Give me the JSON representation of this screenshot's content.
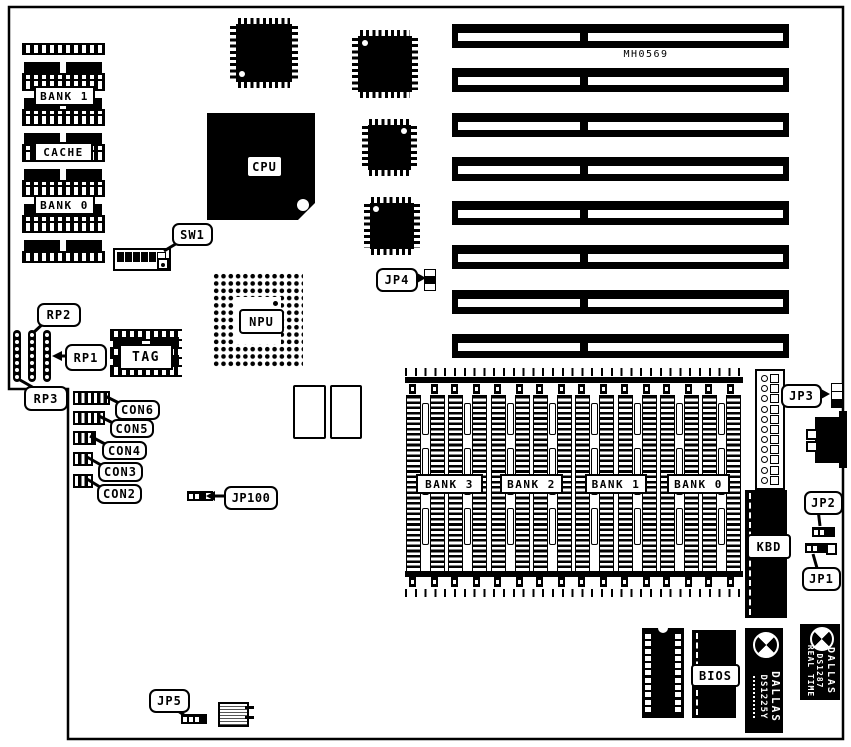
{
  "board": {
    "marking": "MH0569",
    "cache_block": {
      "bank1": "BANK 1",
      "cache": "CACHE",
      "bank0": "BANK 0"
    },
    "cpu_label": "CPU",
    "npu_label": "NPU",
    "tag_label": "TAG",
    "sw1_label": "SW1",
    "kbd_label": "KBD",
    "bios_label": "BIOS",
    "rp": {
      "rp1": "RP1",
      "rp2": "RP2",
      "rp3": "RP3"
    },
    "con": {
      "con2": "CON2",
      "con3": "CON3",
      "con4": "CON4",
      "con5": "CON5",
      "con6": "CON6"
    },
    "jp": {
      "jp1": "JP1",
      "jp2": "JP2",
      "jp3": "JP3",
      "jp4": "JP4",
      "jp5": "JP5",
      "jp100": "JP100"
    },
    "memory": {
      "banks": [
        "BANK 3",
        "BANK 2",
        "BANK 1",
        "BANK 0"
      ]
    },
    "nvram_chip": {
      "brand": "DALLAS",
      "part": "DS1225Y"
    },
    "rtc_chip": {
      "brand": "DALLAS",
      "part": "DS1287",
      "line3": "REAL TIME"
    },
    "counts": {
      "isa_slots": 8,
      "simm_sockets": 8,
      "cache_units": 6,
      "rp_packs": 3,
      "eprom_pads": 11,
      "power_pins": 11,
      "rp_dots": 7
    },
    "colors": {
      "ink": "#000000",
      "paper": "#ffffff"
    }
  }
}
